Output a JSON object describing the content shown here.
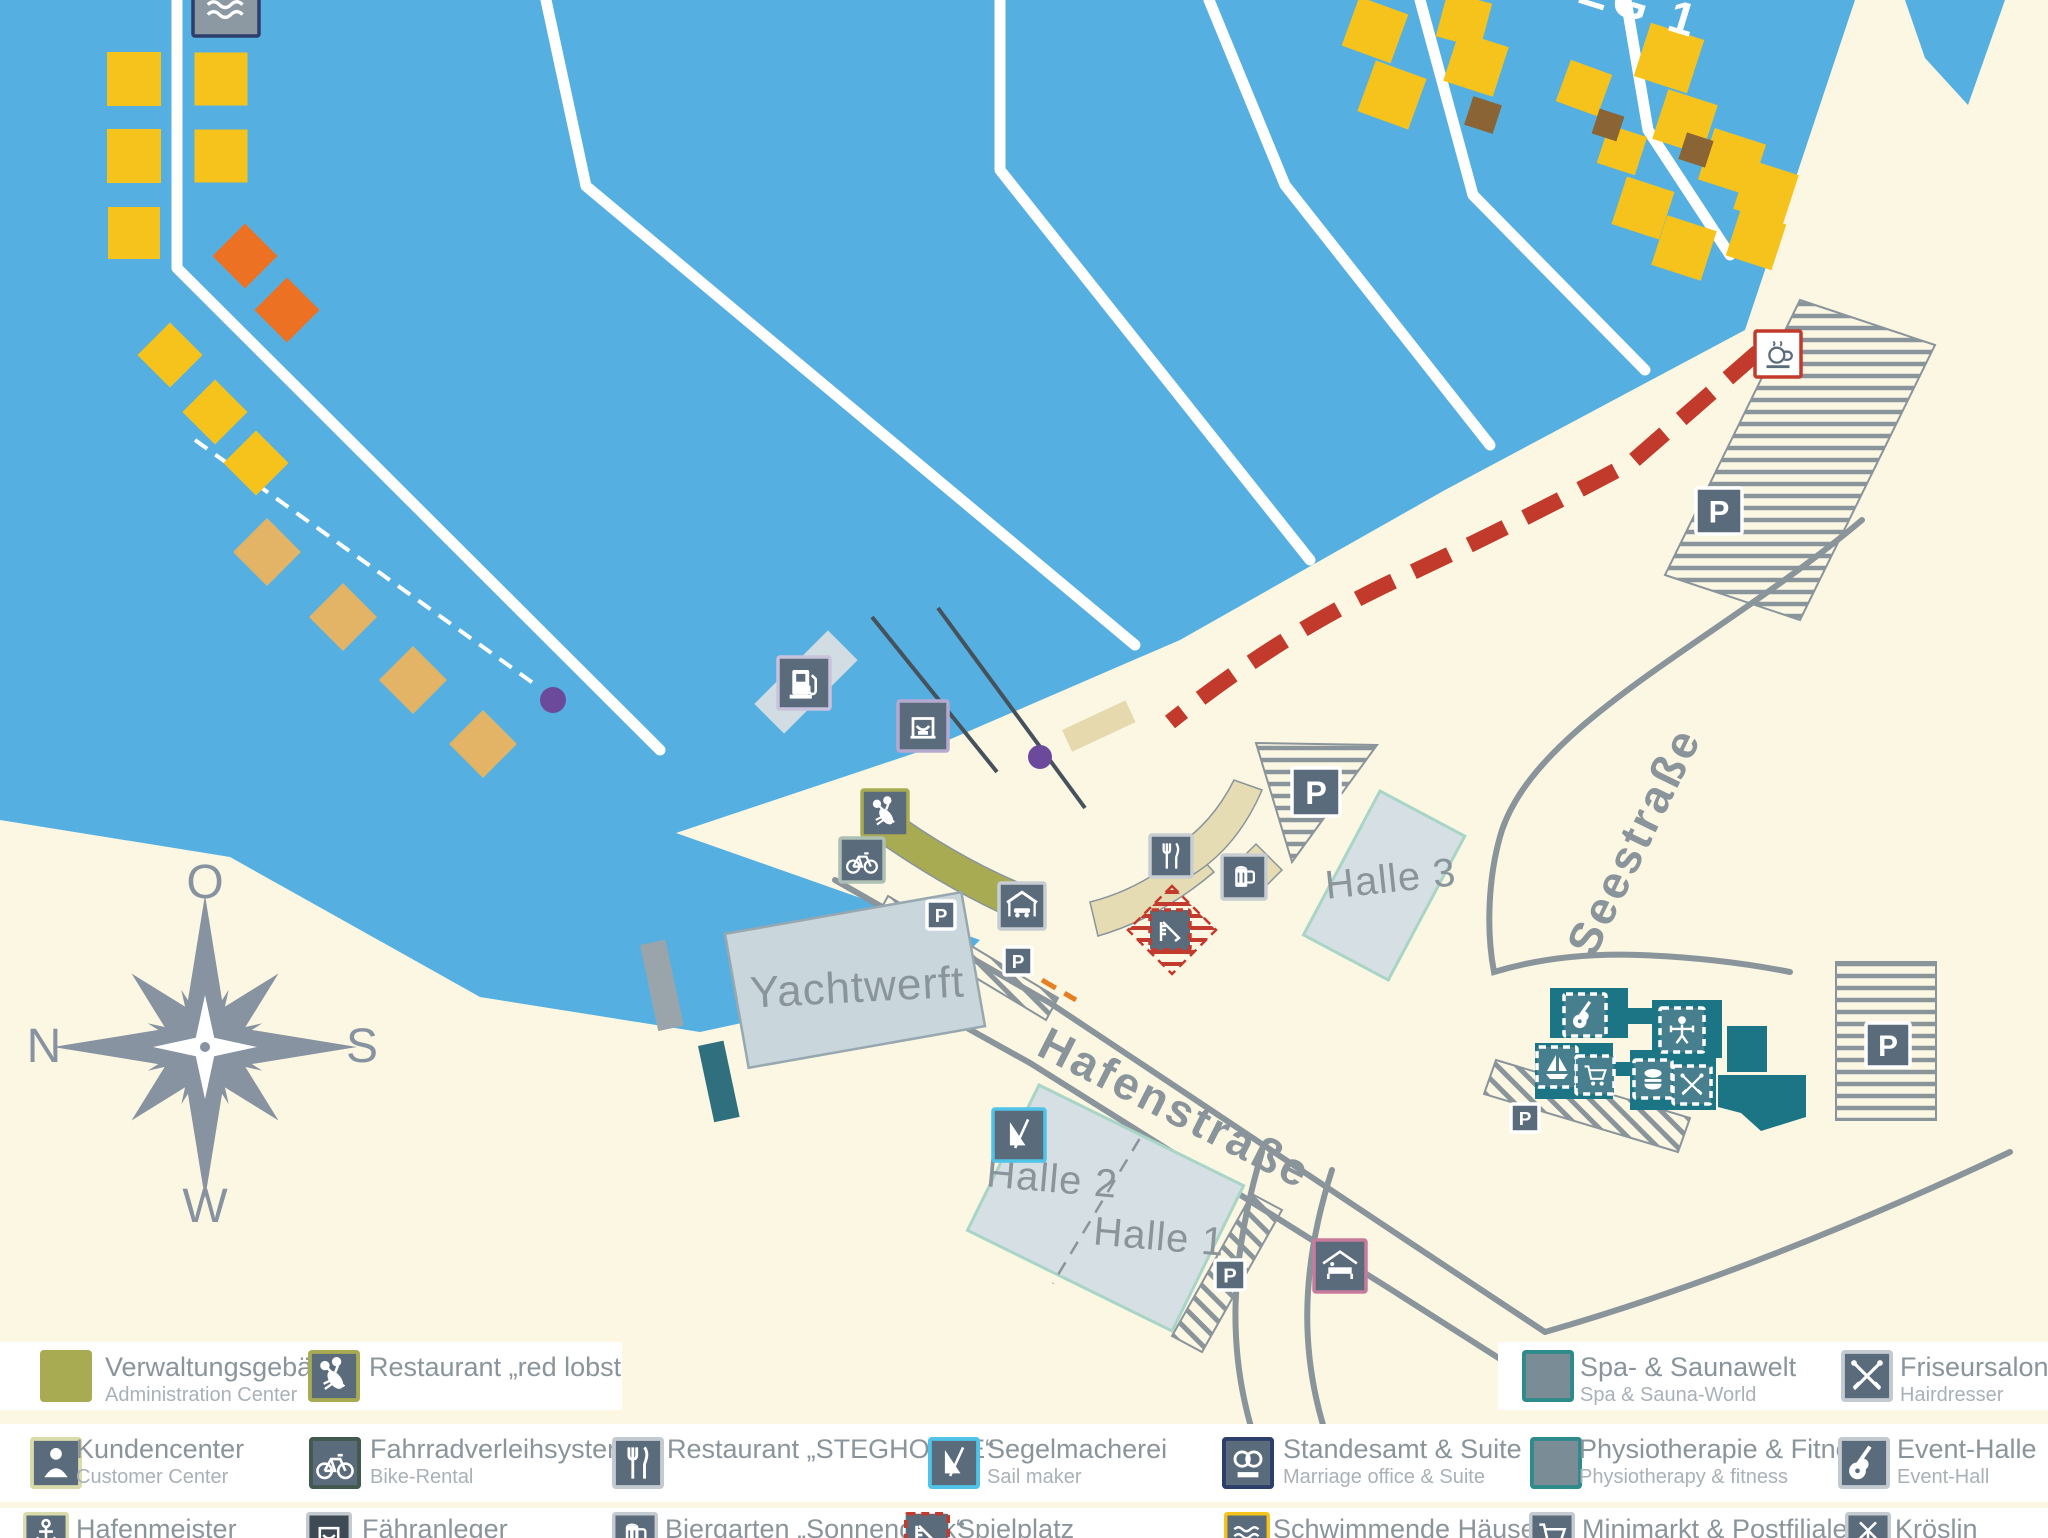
{
  "colors": {
    "water": "#55AFE0",
    "land": "#FBF7E3",
    "gold": "#F6C31C",
    "orange": "#EC7123",
    "tan": "#E3B466",
    "brown": "#8A6434",
    "road": "#8A949B",
    "slate": "#5A6B7C",
    "olive": "#A9AB52",
    "beige": "#E6DCB4",
    "teal": "#1B7585",
    "tealicon": "#477F8E",
    "tealborder": "#2E8B8B",
    "halle": "#D6DFE3",
    "halleborder": "#A8D5C6",
    "ywerft": "#C9D6DC",
    "red": "#C13A2C",
    "purple": "#6B4A9B",
    "textgray": "#8A949B",
    "compass": "#8793A0"
  },
  "compass": {
    "top": "O",
    "left": "N",
    "right": "S",
    "bottom": "W"
  },
  "map_labels": {
    "steg1": "STEG 1",
    "yachtwerft": "Yachtwerft",
    "halle1": "Halle 1",
    "halle2": "Halle 2",
    "halle3": "Halle 3",
    "hafenstrasse": "Hafenstraße",
    "seestrasse": "Seestraße"
  },
  "floating_houses": {
    "gold_squares": [
      [
        134,
        79,
        54,
        0
      ],
      [
        221,
        79,
        53,
        0
      ],
      [
        134,
        156,
        54,
        0
      ],
      [
        221,
        156,
        53,
        0
      ],
      [
        134,
        233,
        52,
        0
      ],
      [
        1375,
        30,
        52,
        20
      ],
      [
        1392,
        95,
        54,
        20
      ],
      [
        1464,
        20,
        46,
        15
      ],
      [
        1476,
        64,
        52,
        18
      ],
      [
        1584,
        88,
        44,
        20
      ],
      [
        1669,
        58,
        56,
        18
      ],
      [
        1685,
        122,
        52,
        18
      ],
      [
        1622,
        150,
        40,
        18
      ],
      [
        1732,
        162,
        54,
        18
      ],
      [
        1643,
        208,
        50,
        18
      ],
      [
        1684,
        248,
        52,
        18
      ],
      [
        1766,
        192,
        52,
        18
      ],
      [
        1756,
        240,
        48,
        18
      ]
    ],
    "gold_diamonds": [
      [
        170,
        355,
        46,
        45
      ],
      [
        215,
        412,
        46,
        45
      ],
      [
        256,
        463,
        46,
        45
      ]
    ],
    "orange_diamonds": [
      [
        245,
        256,
        46,
        45
      ],
      [
        287,
        310,
        46,
        45
      ]
    ],
    "tan_diamonds": [
      [
        267,
        552,
        48,
        45
      ],
      [
        343,
        617,
        48,
        45
      ],
      [
        413,
        680,
        48,
        45
      ],
      [
        483,
        744,
        48,
        45
      ]
    ],
    "brown_squares": [
      [
        1483,
        115,
        30,
        18
      ],
      [
        1608,
        125,
        26,
        18
      ],
      [
        1696,
        150,
        28,
        18
      ]
    ]
  },
  "map_icons": [
    {
      "name": "schwimmende-haeuser-icon",
      "glyph": "waves",
      "x": 193,
      "y": -30,
      "s": 66,
      "bg": "#8C98A2",
      "border": "#2C3E6B"
    },
    {
      "name": "fuel-station-icon",
      "glyph": "gas",
      "x": 778,
      "y": 657,
      "s": 52,
      "bg": "#5A6B7C",
      "border": "#C9C2DC"
    },
    {
      "name": "ferry-terminal-icon",
      "glyph": "ferry",
      "x": 898,
      "y": 701,
      "s": 50,
      "bg": "#5A6B7C",
      "border": "#B4A9CF"
    },
    {
      "name": "red-lobster-icon",
      "glyph": "lobster",
      "x": 862,
      "y": 790,
      "s": 46,
      "bg": "#5A6B7C",
      "border": "#A9AB52"
    },
    {
      "name": "bike-rental-icon",
      "glyph": "bike",
      "x": 840,
      "y": 838,
      "s": 44,
      "bg": "#5A6B7C",
      "border": "#AEBFB4"
    },
    {
      "name": "parking-icon-quay-1",
      "glyph": "P",
      "x": 927,
      "y": 901,
      "s": 28,
      "bg": "#5A6B7C",
      "border": "#FFFFFF"
    },
    {
      "name": "carport-icon",
      "glyph": "carport",
      "x": 999,
      "y": 883,
      "s": 46,
      "bg": "#5A6B7C",
      "border": "#C8CDD1"
    },
    {
      "name": "parking-icon-quay-2",
      "glyph": "P",
      "x": 1004,
      "y": 947,
      "s": 28,
      "bg": "#5A6B7C",
      "border": "#FFFFFF"
    },
    {
      "name": "steghouse-restaurant-icon",
      "glyph": "fork",
      "x": 1150,
      "y": 835,
      "s": 42,
      "bg": "#5A6B7C",
      "border": "#C8CDD1"
    },
    {
      "name": "biergarten-icon",
      "glyph": "beer",
      "x": 1222,
      "y": 855,
      "s": 44,
      "bg": "#5A6B7C",
      "border": "#C8CDD1"
    },
    {
      "name": "parking-icon-halle3",
      "glyph": "P",
      "x": 1292,
      "y": 768,
      "s": 48,
      "bg": "#5A6B7C",
      "border": "#FFFFFF"
    },
    {
      "name": "spielplatz-icon",
      "glyph": "slide",
      "x": 1150,
      "y": 910,
      "s": 40,
      "bg": "#5A6B7C",
      "border": "#C23B2E",
      "style": "dashed"
    },
    {
      "name": "cafe-icon",
      "glyph": "cup",
      "x": 1755,
      "y": 331,
      "s": 46,
      "bg": "#FFFFFF",
      "border": "#C13A2C",
      "fg": "#5A6B7C"
    },
    {
      "name": "parking-icon-northeast",
      "glyph": "P",
      "x": 1696,
      "y": 488,
      "s": 46,
      "bg": "#5A6B7C",
      "border": "#FFFFFF"
    },
    {
      "name": "parking-icon-east",
      "glyph": "P",
      "x": 1866,
      "y": 1023,
      "s": 44,
      "bg": "#5A6B7C",
      "border": "#FFFFFF"
    },
    {
      "name": "parking-icon-hafenstrasse",
      "glyph": "P",
      "x": 1215,
      "y": 1260,
      "s": 30,
      "bg": "#5A6B7C",
      "border": "#FFFFFF"
    },
    {
      "name": "parking-icon-seestrasse",
      "glyph": "P",
      "x": 1511,
      "y": 1104,
      "s": 28,
      "bg": "#5A6B7C",
      "border": "#FFFFFF"
    },
    {
      "name": "segelmacherei-icon",
      "glyph": "sail",
      "x": 993,
      "y": 1109,
      "s": 52,
      "bg": "#5A6B7C",
      "border": "#4FC3E8"
    },
    {
      "name": "pension-icon",
      "glyph": "housebed",
      "x": 1314,
      "y": 1240,
      "s": 52,
      "bg": "#5A6B7C",
      "border": "#C77B9B"
    },
    {
      "name": "event-halle-icon",
      "glyph": "guitar",
      "x": 1564,
      "y": 994,
      "s": 42,
      "bg": "#477F8E",
      "border": "#FFFFFF",
      "style": "dashed"
    },
    {
      "name": "physiotherapie-icon",
      "glyph": "physio",
      "x": 1660,
      "y": 1008,
      "s": 44,
      "bg": "#477F8E",
      "border": "#FFFFFF",
      "style": "dashed"
    },
    {
      "name": "sailboat-icon",
      "glyph": "sailboat",
      "x": 1537,
      "y": 1047,
      "s": 40,
      "bg": "#477F8E",
      "border": "#FFFFFF",
      "style": "dashed"
    },
    {
      "name": "minimarkt-icon",
      "glyph": "cart",
      "x": 1576,
      "y": 1056,
      "s": 38,
      "bg": "#477F8E",
      "border": "#FFFFFF",
      "style": "dashed"
    },
    {
      "name": "burger-icon",
      "glyph": "burger",
      "x": 1634,
      "y": 1060,
      "s": 38,
      "bg": "#477F8E",
      "border": "#FFFFFF",
      "style": "dashed"
    },
    {
      "name": "friseursalon-icon",
      "glyph": "scissors",
      "x": 1673,
      "y": 1066,
      "s": 38,
      "bg": "#477F8E",
      "border": "#FFFFFF",
      "style": "dashed"
    }
  ],
  "legend": {
    "rows": [
      {
        "name": "row-1",
        "y": 1342,
        "h": 68,
        "icon_s": 52,
        "bands": [
          {
            "x": 0,
            "w": 622
          },
          {
            "x": 1498,
            "w": 550
          }
        ],
        "items": [
          {
            "name": "verwaltungsgebaeude",
            "icon": {
              "glyph": "square",
              "bg": "#A9AB52",
              "border": "#A9AB52"
            },
            "x": 40,
            "tx": 105,
            "title": "Verwaltungsgebäude",
            "subtitle": "Administration Center"
          },
          {
            "name": "restaurant-red-lobster",
            "icon": {
              "glyph": "lobster",
              "bg": "#5A6B7C",
              "border": "#A9AB52"
            },
            "x": 308,
            "tx": 369,
            "title": "Restaurant „red lobster“",
            "subtitle": ""
          },
          {
            "name": "spa-saunawelt",
            "icon": {
              "glyph": "square",
              "bg": "#7A8C96",
              "border": "#2E8B8B"
            },
            "x": 1522,
            "tx": 1580,
            "title": "Spa- & Saunawelt",
            "subtitle": "Spa & Sauna-World"
          },
          {
            "name": "friseursalon",
            "icon": {
              "glyph": "scissors",
              "bg": "#5A6B7C",
              "border": "#C4CBD0"
            },
            "x": 1841,
            "tx": 1900,
            "title": "Friseursalon",
            "subtitle": "Hairdresser"
          }
        ]
      },
      {
        "name": "row-2",
        "y": 1424,
        "h": 78,
        "icon_s": 52,
        "bands": [
          {
            "x": 0,
            "w": 2048
          }
        ],
        "items": [
          {
            "name": "kundencenter",
            "icon": {
              "glyph": "person",
              "bg": "#5A6B7C",
              "border": "#D9DBAB"
            },
            "x": 30,
            "tx": 76,
            "title": "Kundencenter",
            "subtitle": "Customer Center"
          },
          {
            "name": "fahrradverleihsystem",
            "icon": {
              "glyph": "bike",
              "bg": "#5A6B7C",
              "border": "#42594E"
            },
            "x": 309,
            "tx": 370,
            "title": "Fahrradverleihsystem",
            "subtitle": "Bike-Rental"
          },
          {
            "name": "restaurant-steghouse",
            "icon": {
              "glyph": "fork",
              "bg": "#5A6B7C",
              "border": "#C4CBD0"
            },
            "x": 612,
            "tx": 667,
            "title": "Restaurant „STEGHOUSE“",
            "subtitle": ""
          },
          {
            "name": "segelmacherei",
            "icon": {
              "glyph": "sail",
              "bg": "#5A6B7C",
              "border": "#4FC3E8"
            },
            "x": 928,
            "tx": 987,
            "title": "Segelmacherei",
            "subtitle": "Sail maker"
          },
          {
            "name": "standesamt-suite",
            "icon": {
              "glyph": "rings",
              "bg": "#5A6B7C",
              "border": "#2C3E6B"
            },
            "x": 1222,
            "tx": 1283,
            "title": "Standesamt & Suite",
            "subtitle": "Marriage office & Suite"
          },
          {
            "name": "physiotherapie-fitness",
            "icon": {
              "glyph": "square",
              "bg": "#7A8C96",
              "border": "#2E8B8B"
            },
            "x": 1530,
            "tx": 1579,
            "title": "Physiotherapie & Fitness",
            "subtitle": "Physiotherapy & fitness"
          },
          {
            "name": "event-halle",
            "icon": {
              "glyph": "guitar",
              "bg": "#5A6B7C",
              "border": "#C4CBD0"
            },
            "x": 1838,
            "tx": 1897,
            "title": "Event-Halle",
            "subtitle": "Event-Hall"
          }
        ]
      },
      {
        "name": "row-3",
        "y": 1508,
        "h": 30,
        "icon_s": 46,
        "bands": [
          {
            "x": 0,
            "w": 2048
          }
        ],
        "items": [
          {
            "name": "hafenmeister",
            "icon": {
              "glyph": "anchor",
              "bg": "#5A6B7C",
              "border": "#D9DBAB"
            },
            "x": 23,
            "tx": 76,
            "title": "Hafenmeister",
            "subtitle": ""
          },
          {
            "name": "faehranleger",
            "icon": {
              "glyph": "ferry",
              "bg": "#3E4A54",
              "border": "#C4CBD0"
            },
            "x": 306,
            "tx": 362,
            "title": "Fähranleger",
            "subtitle": ""
          },
          {
            "name": "biergarten-sonnendeck",
            "icon": {
              "glyph": "beer",
              "bg": "#5A6B7C",
              "border": "#C4CBD0"
            },
            "x": 612,
            "tx": 665,
            "title": "Biergarten „Sonnendeck“",
            "subtitle": ""
          },
          {
            "name": "spielplatz",
            "icon": {
              "glyph": "slide",
              "bg": "#5A6B7C",
              "border": "#C23B2E",
              "style": "dashed"
            },
            "x": 904,
            "tx": 957,
            "title": "Spielplatz",
            "subtitle": ""
          },
          {
            "name": "schwimmende-haeuser",
            "icon": {
              "glyph": "waves",
              "bg": "#5A6B7C",
              "border": "#F6C31C"
            },
            "x": 1224,
            "tx": 1273,
            "title": "Schwimmende Häuser",
            "subtitle": ""
          },
          {
            "name": "minimarkt-postfiliale",
            "icon": {
              "glyph": "cart",
              "bg": "#5A6B7C",
              "border": "#C4CBD0"
            },
            "x": 1529,
            "tx": 1582,
            "title": "Minimarkt & Postfiliale",
            "subtitle": ""
          },
          {
            "name": "kroeslin",
            "icon": {
              "glyph": "mill",
              "bg": "#5A6B7C",
              "border": "#C4CBD0"
            },
            "x": 1845,
            "tx": 1895,
            "title": "Kröslin",
            "subtitle": ""
          }
        ]
      }
    ]
  }
}
